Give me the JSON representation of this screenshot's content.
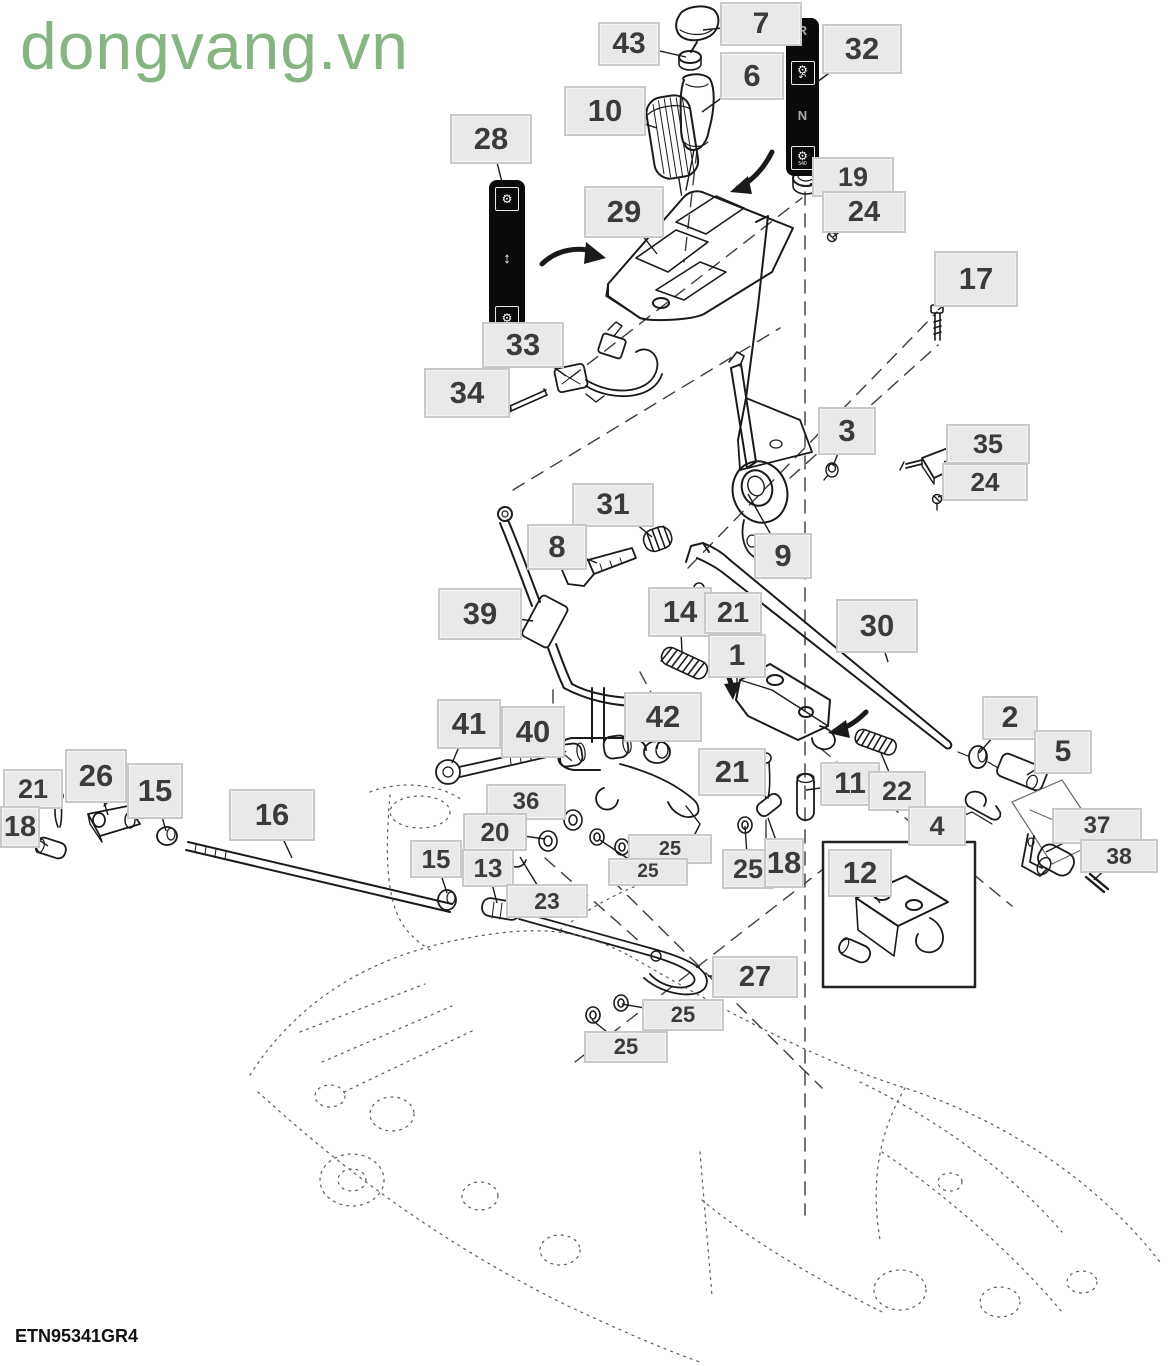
{
  "watermark": "dongvang.vn",
  "drawing_code": "ETN95341GR4",
  "colors": {
    "watermark_green": "#86b583",
    "label_bg": "#e9e9e9",
    "label_border": "#c9c9c9",
    "label_text": "#3b3b3b",
    "line_black": "#1a1a1a",
    "decal_bg": "#0b0b0b"
  },
  "decal_32": {
    "top_letter": "R",
    "mid_letter": "N",
    "icon": "gear-icon",
    "rotate_icon": "rotate-arrow-icon",
    "bottom_caption": "540"
  },
  "decal_28": {
    "icon": "gear-icon",
    "arrow_icon": "up-down-arrow-icon"
  },
  "callouts": [
    {
      "n": "7",
      "x": 720,
      "y": 2,
      "w": 82,
      "h": 44,
      "tx": 703,
      "ty": 30
    },
    {
      "n": "43",
      "x": 598,
      "y": 22,
      "w": 62,
      "h": 44,
      "tx": 686,
      "ty": 57
    },
    {
      "n": "6",
      "x": 720,
      "y": 52,
      "w": 64,
      "h": 48,
      "tx": 702,
      "ty": 112
    },
    {
      "n": "32",
      "x": 822,
      "y": 24,
      "w": 80,
      "h": 50,
      "tx": 817,
      "ty": 82
    },
    {
      "n": "10",
      "x": 564,
      "y": 86,
      "w": 82,
      "h": 50,
      "tx": 657,
      "ty": 128
    },
    {
      "n": "28",
      "x": 450,
      "y": 114,
      "w": 82,
      "h": 50,
      "tx": 503,
      "ty": 186
    },
    {
      "n": "19",
      "x": 812,
      "y": 157,
      "w": 82,
      "h": 40,
      "tx": 810,
      "ty": 184
    },
    {
      "n": "24",
      "x": 822,
      "y": 191,
      "w": 84,
      "h": 42,
      "tx": 833,
      "ty": 237
    },
    {
      "n": "29",
      "x": 584,
      "y": 186,
      "w": 80,
      "h": 52,
      "tx": 657,
      "ty": 254
    },
    {
      "n": "17",
      "x": 934,
      "y": 251,
      "w": 84,
      "h": 56,
      "tx": 938,
      "ty": 310
    },
    {
      "n": "33",
      "x": 482,
      "y": 322,
      "w": 82,
      "h": 46,
      "tx": 566,
      "ty": 376
    },
    {
      "n": "34",
      "x": 424,
      "y": 368,
      "w": 86,
      "h": 50,
      "tx": 503,
      "ty": 406
    },
    {
      "n": "3",
      "x": 818,
      "y": 407,
      "w": 58,
      "h": 48,
      "tx": 833,
      "ty": 466
    },
    {
      "n": "35",
      "x": 946,
      "y": 424,
      "w": 84,
      "h": 40,
      "tx": 944,
      "ty": 462
    },
    {
      "n": "24",
      "x": 942,
      "y": 463,
      "w": 86,
      "h": 38,
      "tx": 938,
      "ty": 497
    },
    {
      "n": "31",
      "x": 572,
      "y": 483,
      "w": 82,
      "h": 44,
      "tx": 652,
      "ty": 537
    },
    {
      "n": "8",
      "x": 527,
      "y": 524,
      "w": 60,
      "h": 46,
      "tx": 597,
      "ty": 563
    },
    {
      "n": "9",
      "x": 754,
      "y": 533,
      "w": 58,
      "h": 46,
      "tx": 748,
      "ty": 494
    },
    {
      "n": "39",
      "x": 438,
      "y": 588,
      "w": 84,
      "h": 52,
      "tx": 533,
      "ty": 621
    },
    {
      "n": "14",
      "x": 648,
      "y": 587,
      "w": 64,
      "h": 50,
      "tx": 682,
      "ty": 652
    },
    {
      "n": "21",
      "x": 704,
      "y": 592,
      "w": 58,
      "h": 42,
      "tx": 701,
      "ty": 601
    },
    {
      "n": "30",
      "x": 836,
      "y": 599,
      "w": 82,
      "h": 54,
      "tx": 888,
      "ty": 662
    },
    {
      "n": "1",
      "x": 708,
      "y": 634,
      "w": 58,
      "h": 44,
      "tx": 737,
      "ty": 698
    },
    {
      "n": "41",
      "x": 437,
      "y": 699,
      "w": 64,
      "h": 50,
      "tx": 452,
      "ty": 763
    },
    {
      "n": "40",
      "x": 501,
      "y": 706,
      "w": 64,
      "h": 52,
      "tx": 566,
      "ty": 752
    },
    {
      "n": "42",
      "x": 624,
      "y": 692,
      "w": 78,
      "h": 50,
      "tx": 657,
      "ty": 749
    },
    {
      "n": "21",
      "x": 698,
      "y": 748,
      "w": 68,
      "h": 48,
      "tx": 764,
      "ty": 772
    },
    {
      "n": "2",
      "x": 982,
      "y": 696,
      "w": 56,
      "h": 44,
      "tx": 979,
      "ty": 753
    },
    {
      "n": "5",
      "x": 1034,
      "y": 730,
      "w": 58,
      "h": 44,
      "tx": 1027,
      "ty": 775
    },
    {
      "n": "11",
      "x": 820,
      "y": 762,
      "w": 60,
      "h": 44,
      "tx": 806,
      "ty": 790
    },
    {
      "n": "22",
      "x": 868,
      "y": 771,
      "w": 58,
      "h": 40,
      "tx": 881,
      "ty": 753
    },
    {
      "n": "4",
      "x": 908,
      "y": 806,
      "w": 58,
      "h": 40,
      "tx": 972,
      "ty": 812
    },
    {
      "n": "37",
      "x": 1052,
      "y": 808,
      "w": 90,
      "h": 36,
      "tx": 1046,
      "ty": 852
    },
    {
      "n": "38",
      "x": 1080,
      "y": 839,
      "w": 78,
      "h": 34,
      "tx": 1094,
      "ty": 880
    },
    {
      "n": "21",
      "x": 3,
      "y": 769,
      "w": 60,
      "h": 40,
      "tx": 59,
      "ty": 801
    },
    {
      "n": "26",
      "x": 65,
      "y": 749,
      "w": 62,
      "h": 54,
      "tx": 108,
      "ty": 815
    },
    {
      "n": "15",
      "x": 127,
      "y": 763,
      "w": 56,
      "h": 56,
      "tx": 166,
      "ty": 831
    },
    {
      "n": "18",
      "x": 0,
      "y": 806,
      "w": 40,
      "h": 42,
      "tx": 48,
      "ty": 846
    },
    {
      "n": "16",
      "x": 229,
      "y": 789,
      "w": 86,
      "h": 52,
      "tx": 292,
      "ty": 858
    },
    {
      "n": "36",
      "x": 486,
      "y": 784,
      "w": 80,
      "h": 36,
      "tx": 566,
      "ty": 816
    },
    {
      "n": "20",
      "x": 463,
      "y": 813,
      "w": 64,
      "h": 38,
      "tx": 545,
      "ty": 839
    },
    {
      "n": "15",
      "x": 410,
      "y": 840,
      "w": 52,
      "h": 38,
      "tx": 447,
      "ty": 893
    },
    {
      "n": "13",
      "x": 462,
      "y": 849,
      "w": 52,
      "h": 38,
      "tx": 497,
      "ty": 903
    },
    {
      "n": "23",
      "x": 506,
      "y": 884,
      "w": 82,
      "h": 34,
      "tx": 520,
      "ty": 857
    },
    {
      "n": "25",
      "x": 628,
      "y": 834,
      "w": 84,
      "h": 30,
      "tx": 640,
      "ty": 846
    },
    {
      "n": "25",
      "x": 608,
      "y": 858,
      "w": 80,
      "h": 28,
      "tx": 600,
      "ty": 840
    },
    {
      "n": "25",
      "x": 722,
      "y": 849,
      "w": 52,
      "h": 40,
      "tx": 745,
      "ty": 826
    },
    {
      "n": "18",
      "x": 764,
      "y": 838,
      "w": 40,
      "h": 50,
      "tx": 768,
      "ty": 818
    },
    {
      "n": "12",
      "x": 828,
      "y": 849,
      "w": 64,
      "h": 48,
      "tx": 880,
      "ty": 903
    },
    {
      "n": "27",
      "x": 712,
      "y": 956,
      "w": 86,
      "h": 42,
      "tx": 708,
      "ty": 976
    },
    {
      "n": "25",
      "x": 642,
      "y": 999,
      "w": 82,
      "h": 32,
      "tx": 622,
      "ty": 1004
    },
    {
      "n": "25",
      "x": 584,
      "y": 1031,
      "w": 84,
      "h": 32,
      "tx": 592,
      "ty": 1020
    }
  ]
}
